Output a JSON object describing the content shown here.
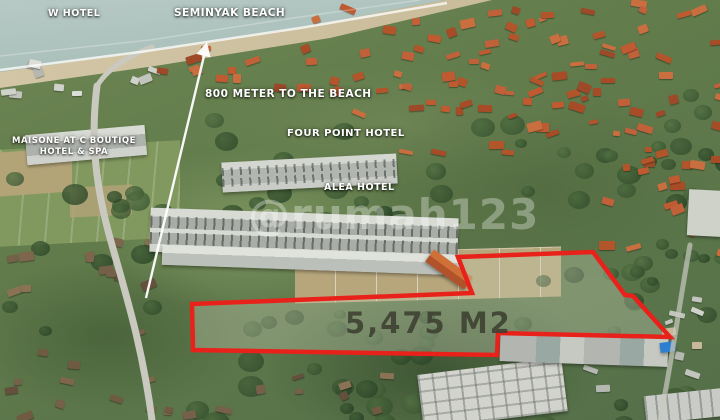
{
  "annotations": {
    "w_hotel": "W HOTEL",
    "seminyak_beach": "SEMINYAK BEACH",
    "distance": "800 METER TO THE BEACH",
    "maisone_line1": "MAISONE AT C BOUTIQE",
    "maisone_line2": "HOTEL & SPA",
    "four_point": "FOUR POINT HOTEL",
    "alea": "ALEA HOTEL"
  },
  "plot": {
    "area_label": "5,475 M2",
    "outline_color": "#e8221a",
    "area_text_color": "#3c4030",
    "polygon_points": "192,304 472,293 458,257 593,252 625,295 633,296 670,337 498,333 497,355 193,350",
    "arrow_shaft_points": "146,298 204,56",
    "arrow_head_points": "207,42 210.5,57.5 196.5,54"
  },
  "watermark": {
    "text": "@rumah123",
    "color": "#ffffff"
  }
}
